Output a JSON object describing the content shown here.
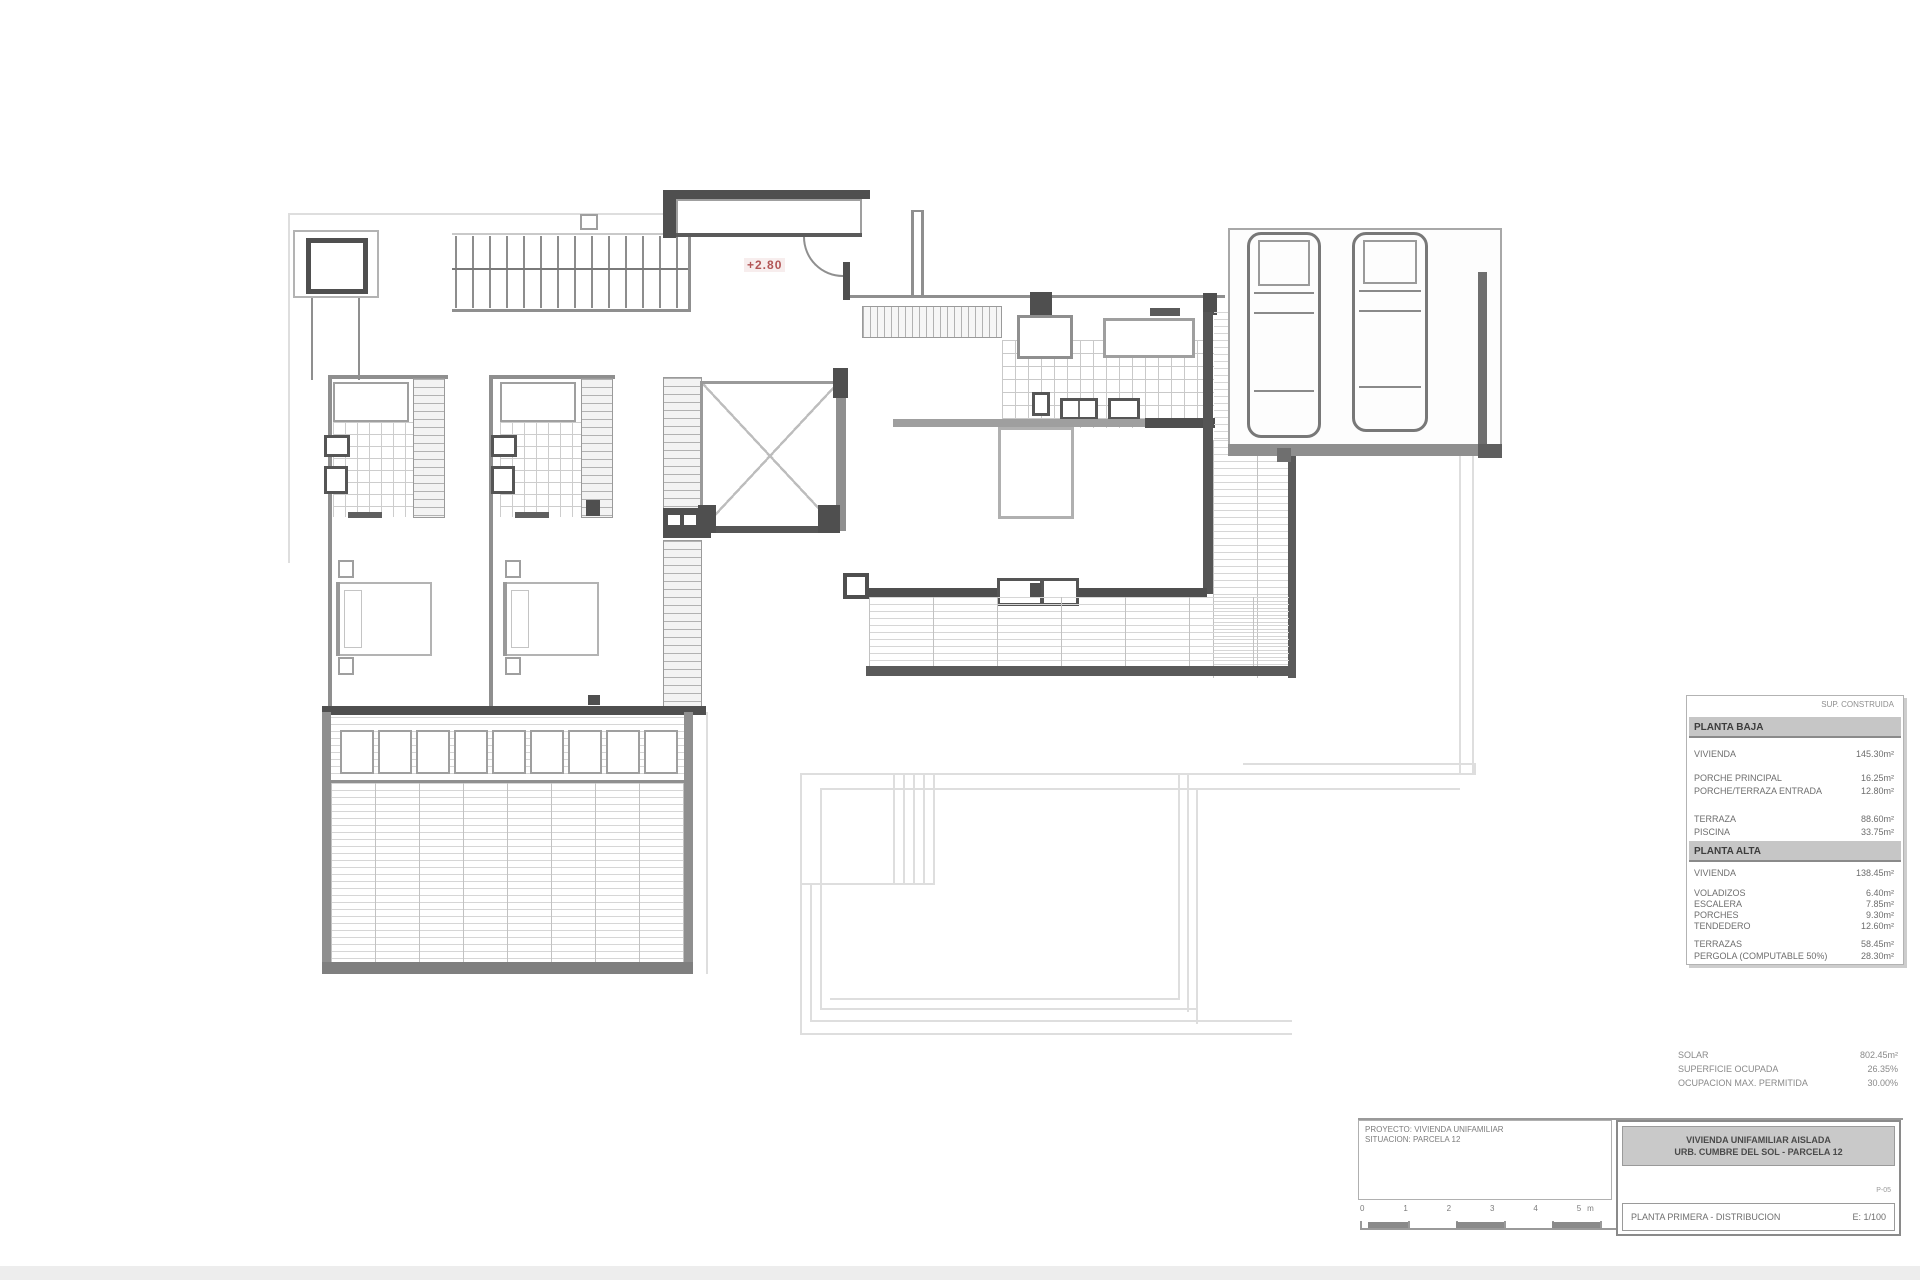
{
  "stamp": "+2.80",
  "table": {
    "note": "SUP. CONSTRUIDA",
    "sections": [
      {
        "title": "PLANTA BAJA",
        "rows": [
          {
            "label": "VIVIENDA",
            "value": "145.30m²"
          },
          {
            "label": "PORCHE PRINCIPAL",
            "value": "16.25m²"
          },
          {
            "label": "PORCHE/TERRAZA ENTRADA",
            "value": "12.80m²"
          },
          {
            "label": "TERRAZA",
            "value": "88.60m²"
          },
          {
            "label": "PISCINA",
            "value": "33.75m²"
          }
        ]
      },
      {
        "title": "PLANTA ALTA",
        "rows": [
          {
            "label": "VIVIENDA",
            "value": "138.45m²"
          },
          {
            "label": "VOLADIZOS",
            "value": "6.40m²"
          },
          {
            "label": "ESCALERA",
            "value": "7.85m²"
          },
          {
            "label": "PORCHES",
            "value": "9.30m²"
          },
          {
            "label": "TENDEDERO",
            "value": "12.60m²"
          },
          {
            "label": "TERRAZAS",
            "value": "58.45m²"
          },
          {
            "label": "PERGOLA (COMPUTABLE 50%)",
            "value": "28.30m²"
          }
        ]
      }
    ]
  },
  "summary": {
    "rows": [
      {
        "label": "SOLAR",
        "value": "802.45m²"
      },
      {
        "label": "SUPERFICIE OCUPADA",
        "value": "26.35%"
      },
      {
        "label": "OCUPACION MAX. PERMITIDA",
        "value": "30.00%"
      }
    ]
  },
  "titleblock": {
    "project_line1": "PROYECTO: VIVIENDA UNIFAMILIAR",
    "project_line2": "SITUACION: PARCELA 12",
    "firm_line1": "VIVIENDA UNIFAMILIAR AISLADA",
    "firm_line2": "URB. CUMBRE DEL SOL - PARCELA 12",
    "sheet_note": "P-05",
    "sheet_title": "PLANTA PRIMERA - DISTRIBUCION",
    "scale": "E: 1/100",
    "scale_labels": "0    1    2    3    4    5m"
  }
}
